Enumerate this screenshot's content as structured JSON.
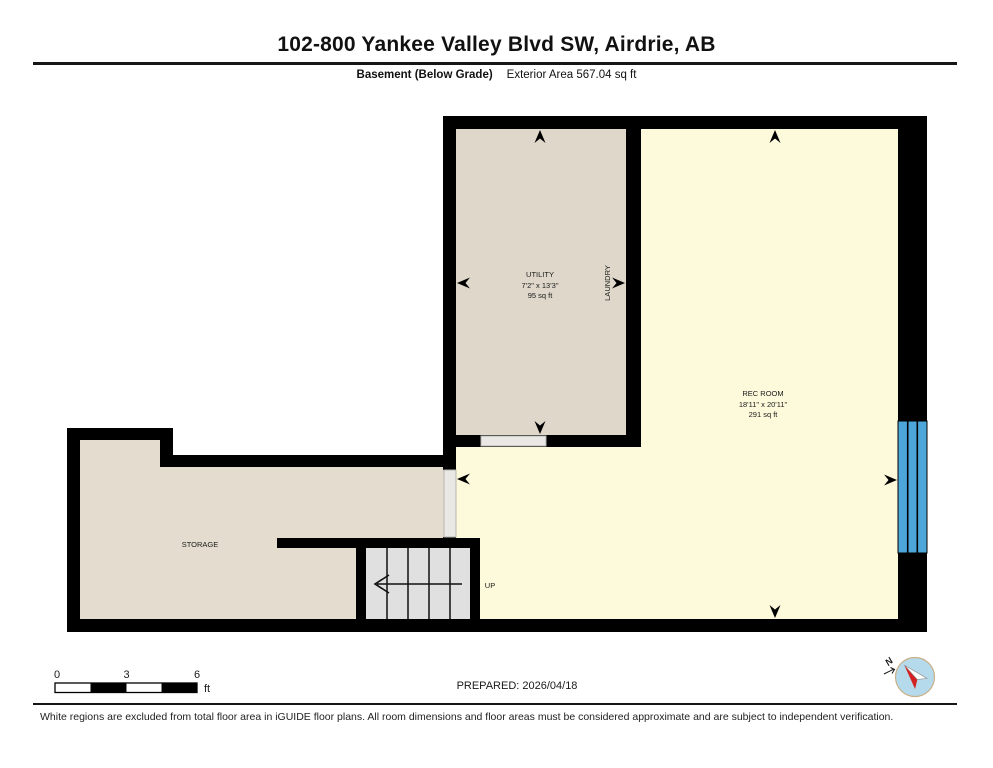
{
  "header": {
    "title": "102-800 Yankee Valley Blvd SW, Airdrie, AB",
    "floor_label": "Basement (Below Grade)",
    "area_label": "Exterior Area 567.04 sq ft"
  },
  "rooms": {
    "utility": {
      "name": "UTILITY",
      "dimensions": "7'2\" x 13'3\"",
      "area": "95 sq ft"
    },
    "laundry": {
      "name": "LAUNDRY"
    },
    "rec_room": {
      "name": "REC ROOM",
      "dimensions": "18'11\" x 20'11\"",
      "area": "291 sq ft"
    },
    "storage": {
      "name": "STORAGE"
    },
    "stairs": {
      "label": "UP"
    }
  },
  "scale_bar": {
    "tick_0": "0",
    "tick_3": "3",
    "tick_6": "6",
    "unit": "ft"
  },
  "prepared_label": "PREPARED: 2026/04/18",
  "compass": {
    "north_label": "N"
  },
  "footer": {
    "disclaimer": "White regions are excluded from total floor area in iGUIDE floor plans. All room dimensions and floor areas must be considered approximate and are subject to independent verification."
  },
  "colors": {
    "wall": "#000000",
    "utility_fill": "#ded7ca",
    "storage_fill": "#e3dccf",
    "rec_fill": "#fdfadb",
    "stairs_fill": "#e0e0e0",
    "door_fill": "#e9e8e4",
    "window_blue": "#4da6d9",
    "compass_blue": "#b5daec",
    "compass_red": "#d42020"
  }
}
